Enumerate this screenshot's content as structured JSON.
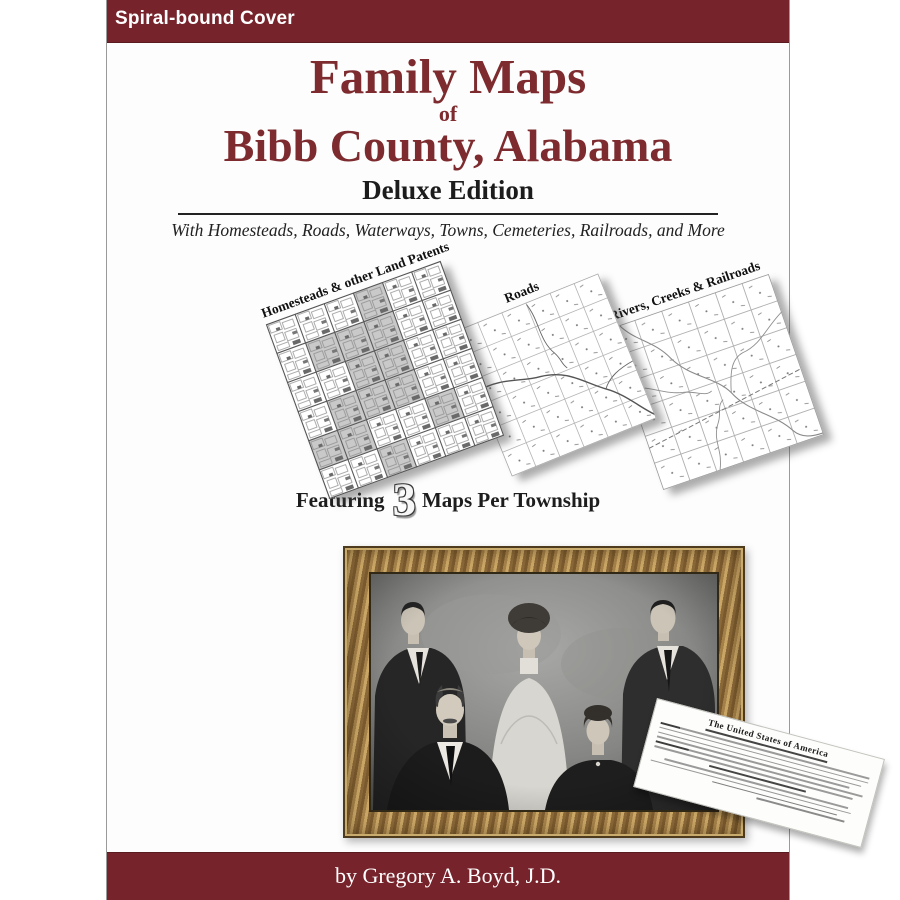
{
  "cover": {
    "top_bar": {
      "label": "Spiral-bound Cover",
      "bg": "#77232b",
      "text_color": "#ffffff"
    },
    "title": {
      "line1": "Family Maps",
      "line2": "of",
      "line3": "Bibb County, Alabama",
      "color": "#7d2b2e"
    },
    "edition": "Deluxe Edition",
    "tagline": "With Homesteads, Roads, Waterways, Towns, Cemeteries, Railroads, and More",
    "maps": [
      {
        "label": "Homesteads & other Land Patents"
      },
      {
        "label": "Roads"
      },
      {
        "label": "Rivers, Creeks & Railroads"
      }
    ],
    "featuring": {
      "prefix": "Featuring",
      "number": "3",
      "suffix": "Maps Per Township"
    },
    "document": {
      "heading": "The United States of America"
    },
    "byline": "by Gregory A. Boyd, J.D.",
    "colors": {
      "maroon_bar": "#77232b",
      "title_maroon": "#7d2b2e"
    }
  }
}
